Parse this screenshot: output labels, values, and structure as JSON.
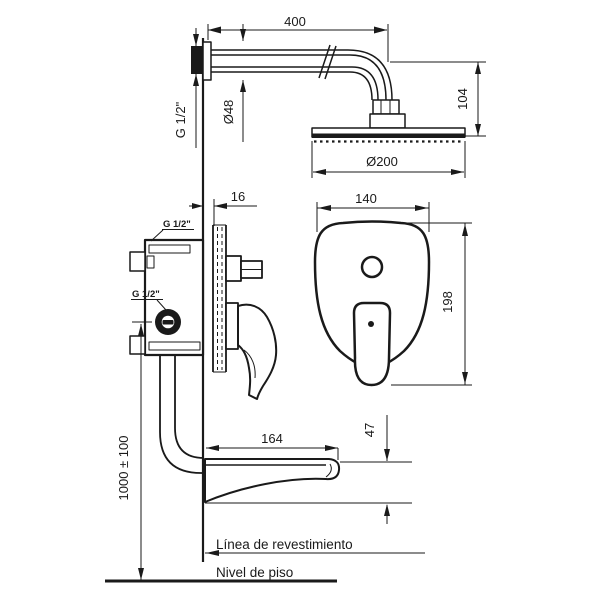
{
  "views": {
    "shower_head": {
      "arm_length": "400",
      "arm_thread": "G 1/2\"",
      "flange_diameter": "Ø48",
      "drop_height": "104",
      "head_diameter": "Ø200"
    },
    "mixer_side": {
      "plate_offset": "16",
      "inlet_thread": "G 1/2\"",
      "outlet_thread": "G 1/2\"",
      "mounting_height": "1000 ± 100"
    },
    "mixer_front": {
      "plate_width": "140",
      "plate_height": "198"
    },
    "spout": {
      "length": "164",
      "height": "47"
    },
    "references": {
      "finish_line": "Línea de revestimiento",
      "floor_line": "Nivel de piso"
    }
  }
}
